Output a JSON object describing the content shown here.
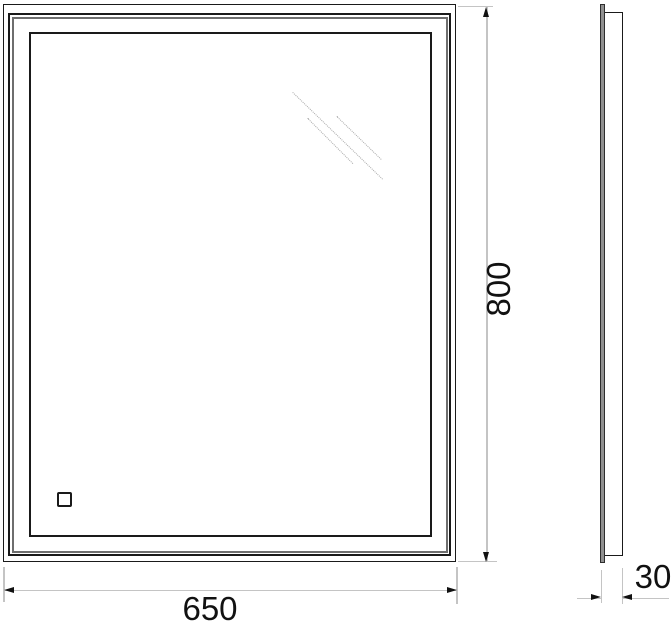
{
  "drawing": {
    "subject": "illuminated-mirror-technical-drawing",
    "views": {
      "front": "front-view-with-frame-and-touch-sensor",
      "side": "side-profile"
    },
    "dimensions": {
      "width": {
        "value": "650"
      },
      "height": {
        "value": "800"
      },
      "depth": {
        "value": "30"
      }
    },
    "colors": {
      "line": "#1a1a1a",
      "shadow_line": "#6e6e6e",
      "dimension_line": "#c4c4c4",
      "reflection_line": "#a9a9a9",
      "glass_fill": "#909090",
      "background": "#ffffff",
      "text": "#111111"
    }
  }
}
